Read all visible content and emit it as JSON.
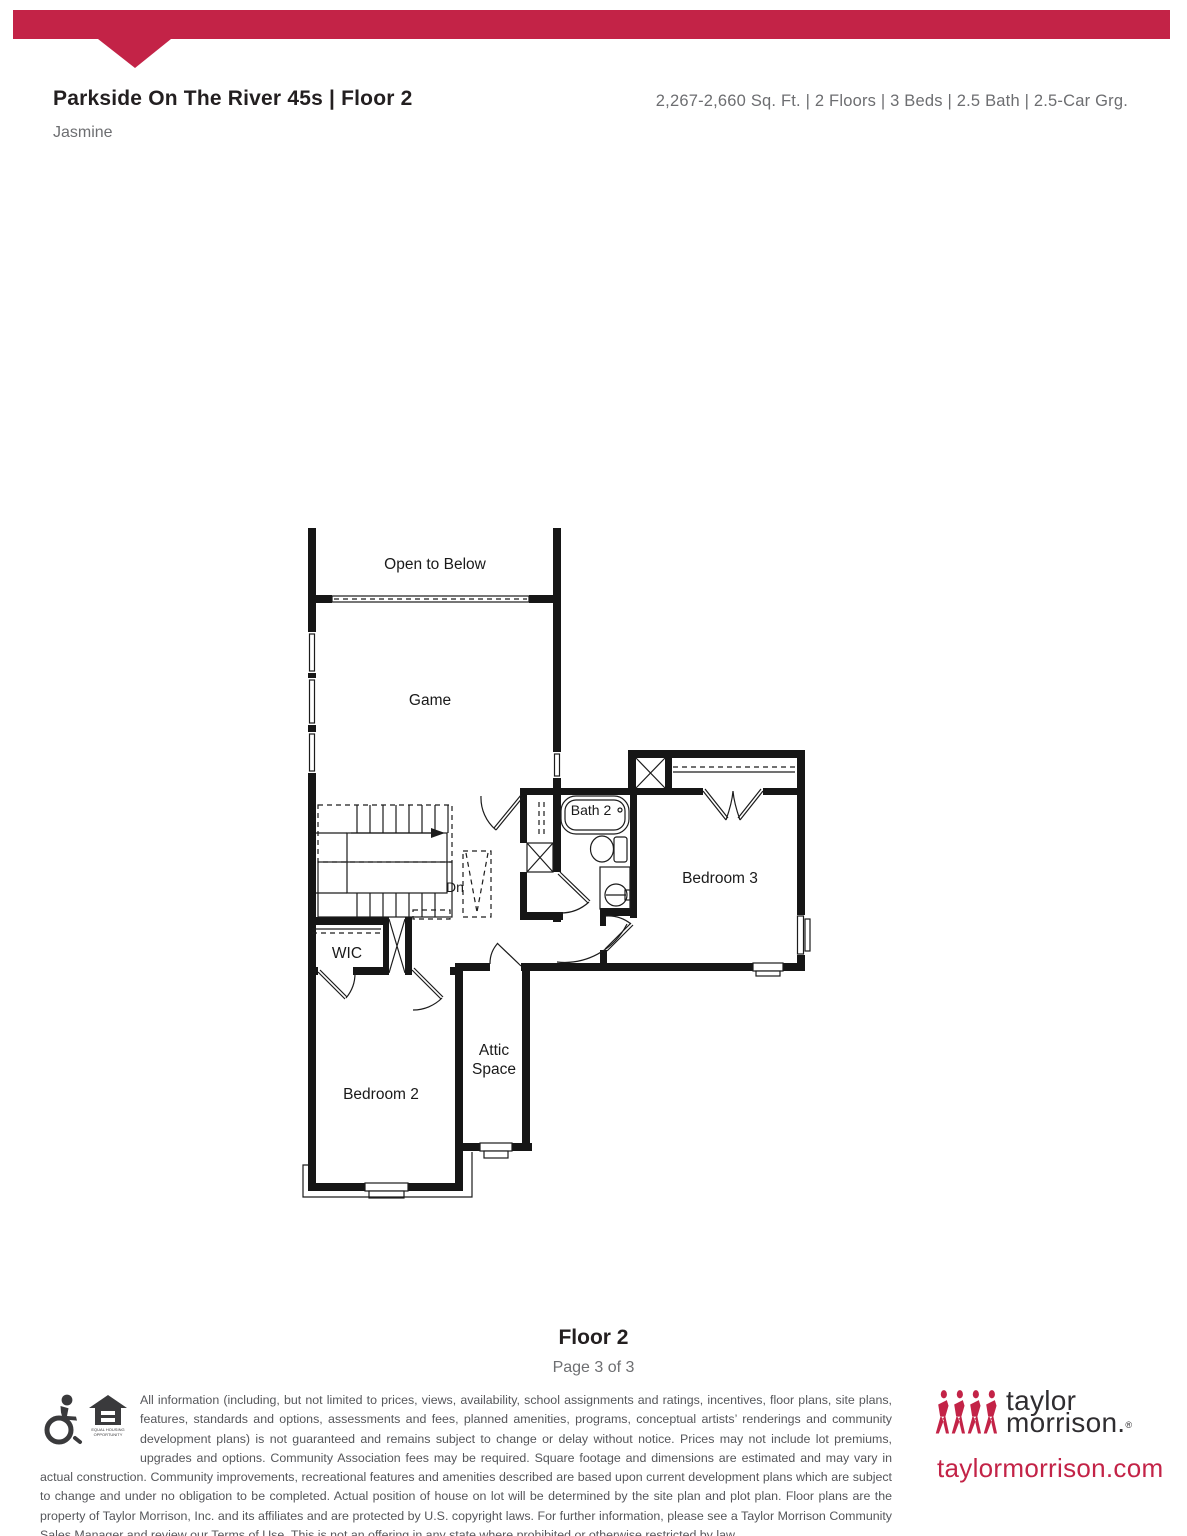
{
  "header": {
    "title": "Parkside On The River 45s | Floor 2",
    "plan_name": "Jasmine",
    "specs": "2,267-2,660 Sq. Ft.  |  2 Floors  |  3 Beds  |  2.5 Bath  |  2.5-Car Grg."
  },
  "floor_plan": {
    "labels": {
      "open_to_below": "Open to Below",
      "game": "Game",
      "stairs_direction": "Dn",
      "wic": "WIC",
      "bath2": "Bath 2",
      "bedroom3": "Bedroom 3",
      "attic_line1": "Attic",
      "attic_line2": "Space",
      "bedroom2": "Bedroom 2"
    }
  },
  "footer": {
    "floor_label": "Floor 2",
    "page_label": "Page 3 of 3",
    "disclaimer": "All information (including, but not limited to prices, views, availability, school assignments and ratings, incentives, floor plans, site plans, features, standards and options, assessments and fees, planned amenities, programs, conceptual artists’ renderings and community development plans) is not guaranteed and remains subject to change or delay without notice. Prices may not include lot premiums, upgrades and options. Community Association fees may be required. Square footage and dimensions are estimated and may vary in actual construction. Community improvements, recreational features and amenities described are based upon current development plans which are subject to change and under no obligation to be completed. Actual position of house on lot will be determined by the site plan and plot plan. Floor plans are the property of Taylor Morrison, Inc. and its affiliates and are protected by U.S. copyright laws. For further information, please see a Taylor Morrison Community Sales Manager and review our Terms of Use. This is not an offering in any state where prohibited or otherwise restricted by law.",
    "equal_housing_caption_line1": "EQUAL HOUSING",
    "equal_housing_caption_line2": "OPPORTUNITY",
    "logo": {
      "line1": "taylor",
      "line2": "morrison.",
      "reg": "®",
      "website": "taylormorrison.com"
    }
  },
  "colors": {
    "brand_red": "#c32347",
    "title_dark": "#231f20",
    "muted_gray": "#6d6e71",
    "disclaimer_gray": "#55565a",
    "plan_line": "#1c1c1c"
  }
}
